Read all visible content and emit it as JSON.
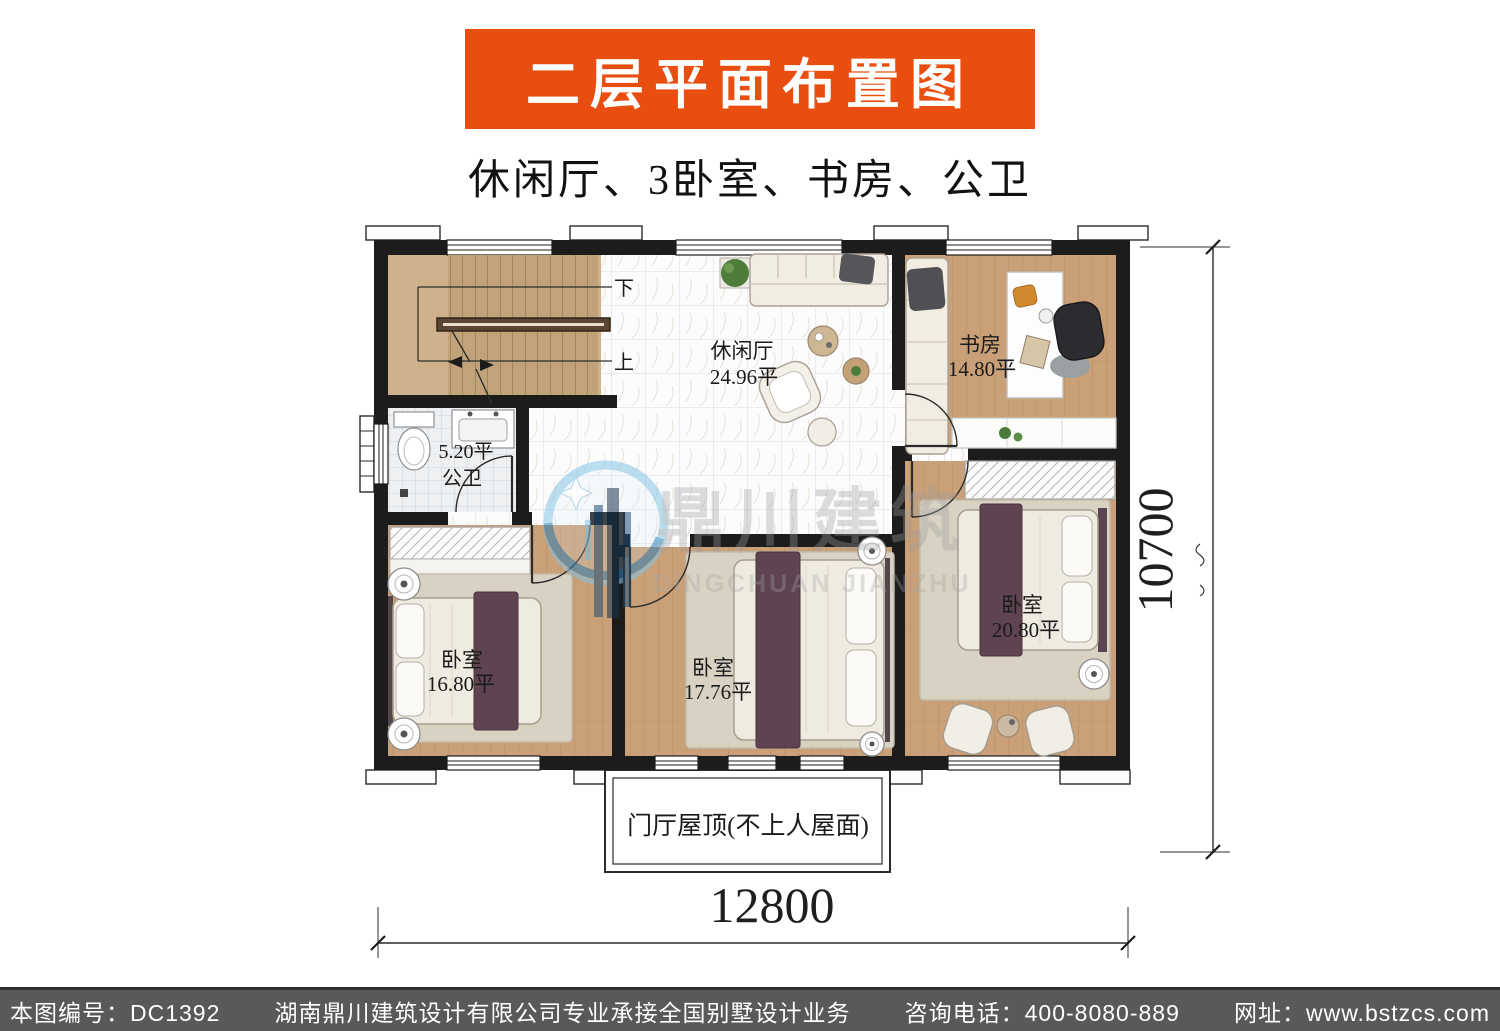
{
  "banner": {
    "title": "二层平面布置图",
    "bg_color": "#e84e0f",
    "text_color": "#ffffff"
  },
  "subtitle": "休闲厅、3卧室、书房、公卫",
  "floor_plan": {
    "rooms": [
      {
        "name": "休闲厅",
        "area": "24.96平"
      },
      {
        "name": "书房",
        "area": "14.80平"
      },
      {
        "name": "公卫",
        "area": "5.20平"
      },
      {
        "name": "卧室",
        "area": "16.80平"
      },
      {
        "name": "卧室",
        "area": "17.76平"
      },
      {
        "name": "卧室",
        "area": "20.80平"
      }
    ],
    "stairs": {
      "down": "下",
      "up": "上"
    },
    "porch_roof_label": "门厅屋顶(不上人屋面)",
    "dimensions": {
      "width_mm": "12800",
      "depth_mm": "10700"
    }
  },
  "watermark": {
    "name_cn": "鼎川建筑",
    "name_en": "DINGCHUAN JIANZHU",
    "logo_blue": "#2e7fb5"
  },
  "footer": {
    "drawing_no": "本图编号：DC1392",
    "company": "湖南鼎川建筑设计有限公司专业承接全国别墅设计业务",
    "phone": "咨询电话：400-8080-889",
    "website": "网址：www.bstzcs.com",
    "bg_color": "#58595b"
  }
}
